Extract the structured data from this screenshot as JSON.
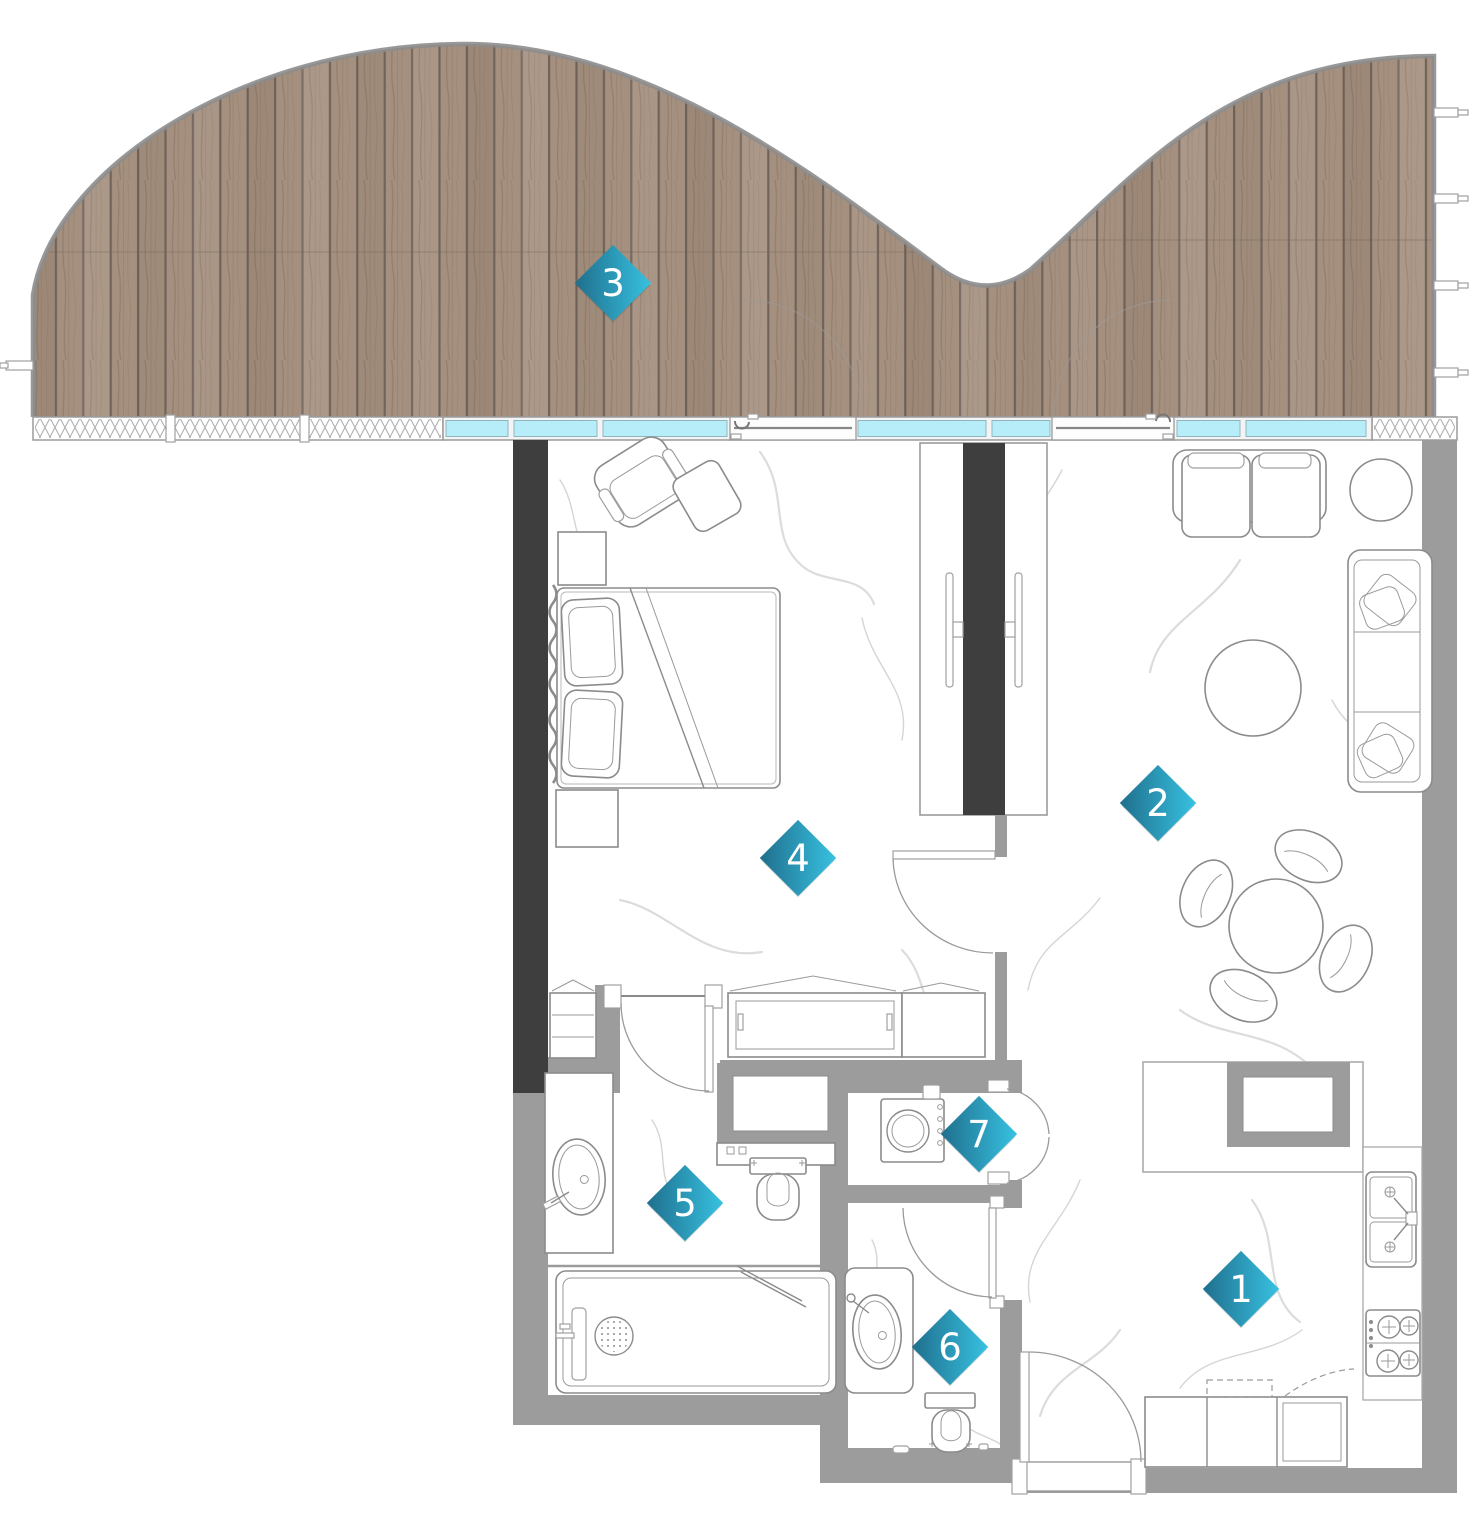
{
  "plan": {
    "markers": [
      {
        "label": "1"
      },
      {
        "label": "2"
      },
      {
        "label": "3"
      },
      {
        "label": "4"
      },
      {
        "label": "5"
      },
      {
        "label": "6"
      },
      {
        "label": "7"
      }
    ],
    "colors": {
      "marker_gradient_start": "#1f6f8d",
      "marker_gradient_end": "#38c1e1",
      "wall": "#9c9c9c",
      "dark_wall": "#3e3e3e",
      "glass": "#b7edf8",
      "wood_base": "#a5907f",
      "wood_gap": "#70635a",
      "outline": "#8d8d8d",
      "fixture_line": "#8b8b8b",
      "marble_vein": "#d6d6d6"
    }
  }
}
